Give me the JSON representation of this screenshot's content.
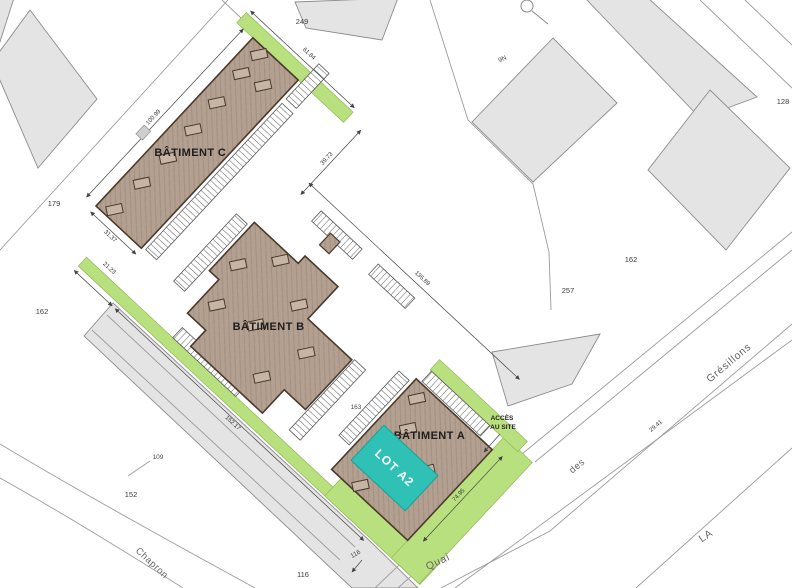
{
  "plan": {
    "buildings": {
      "c": "BÂTIMENT C",
      "b": "BÂTIMENT B",
      "a": "BÂTIMENT A"
    },
    "lot": {
      "label": "LOT A2"
    },
    "access": {
      "line1": "ACCÈS",
      "line2": "AU SITE"
    },
    "parcels": {
      "n249": "249",
      "n179": "179",
      "n162_left": "162",
      "n109": "109",
      "n152": "152",
      "n116_low": "116",
      "n116_edge": "116",
      "n163": "163",
      "n257": "257",
      "n162_right": "162",
      "n128": "128",
      "n9n": "9N"
    },
    "dimensions": {
      "top": "100.99",
      "end_c": "61.84",
      "gap": "39.73",
      "width_c": "31.37",
      "west_short": "21.23",
      "west_long": "152.17",
      "east": "135.89",
      "south_a": "74.95",
      "street": "29.41"
    },
    "streets": {
      "chapron": "Chapron",
      "quai": "Quai",
      "des": "des",
      "gresillons": "Grésillons",
      "la": "LA"
    }
  },
  "colors": {
    "building": "#b3a090",
    "building_stroke": "#4b3a2b",
    "rooflight": "#c6b5a5",
    "green": "#b9e07e",
    "green_stroke": "#90b957",
    "teal": "#2fc1b5",
    "teal_stroke": "#17a297",
    "parcel_gray": "#e4e4e4",
    "parcel_stroke": "#8d8d8d",
    "road": "#9b9b9b"
  }
}
